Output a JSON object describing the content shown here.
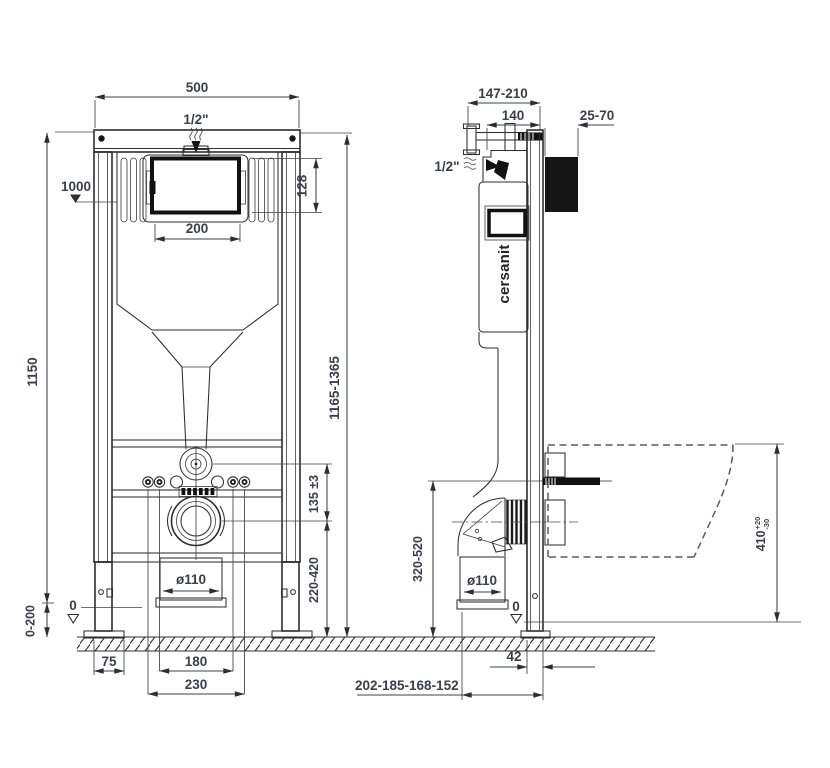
{
  "drawing": {
    "brand": "cersanit",
    "type": "wall-hung WC installation frame, dimensional drawing",
    "colors": {
      "line": "#2e2e2e",
      "dim_text": "#3a4049",
      "background": "#ffffff"
    }
  },
  "front_view": {
    "width": "500",
    "inlet": "1/2\"",
    "water_level": "1000",
    "opening_height": "128",
    "opening_width": "200",
    "frame_height": "1150",
    "install_height": "1165-1365",
    "flush_to_outlet": "135 ±3",
    "outlet_height": "220-420",
    "outlet_dia": "ø110",
    "floor_zero": "0",
    "leg_adjust": "0-200",
    "edge_to_leg": "75",
    "bolts_inner": "180",
    "bolts_outer": "230"
  },
  "side_view": {
    "bracket_depth": "147-210",
    "body_depth": "140",
    "anchor_depth": "25-70",
    "inlet": "1/2\"",
    "logo": "cersanit",
    "outlet_height": "320-520",
    "outlet_dia": "ø110",
    "bowl_height": "410",
    "bowl_tol_plus": "+20",
    "bowl_tol_minus": "-30",
    "floor_zero": "0",
    "profile_depth": "42",
    "outlet_offsets": "202-185-168-152"
  }
}
